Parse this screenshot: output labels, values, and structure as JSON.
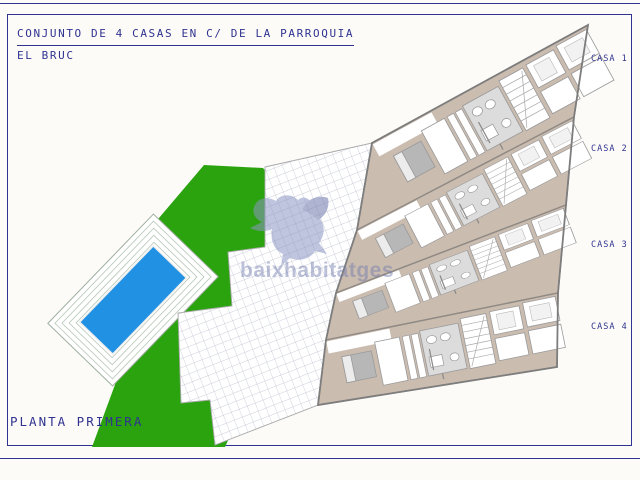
{
  "title_block": {
    "project_title": "CONJUNTO DE 4 CASAS EN C/ DE LA PARROQUIA",
    "location": "EL BRUC"
  },
  "plan": {
    "floor_label": "PLANTA PRIMERA",
    "houses": [
      {
        "label": "CASA 1"
      },
      {
        "label": "CASA 2"
      },
      {
        "label": "CASA 3"
      },
      {
        "label": "CASA 4"
      }
    ],
    "features": {
      "garden": "garden-lawn",
      "pool": "swimming-pool",
      "pool_deck": "pool-deck",
      "terrace": "tiled-terrace",
      "building": "row-of-4-houses"
    }
  },
  "watermark": {
    "text": "baixhabitatges",
    "logo": "dove-icon"
  },
  "colors": {
    "paper": "#fcfbf8",
    "ink": "#303390",
    "garden_green": "#2BA30F",
    "pool_blue": "#2191E3",
    "floor_beige": "#CBBCB0",
    "wall_gray": "#8F8A84",
    "room_line": "#9A9A9A",
    "tile_gray": "#DCDCDC",
    "bed_gray": "#B7B7B7",
    "grid_line": "#BCC0CE",
    "deck_stripe": "#B7C6B7",
    "watermark_blue": "#8C96C4",
    "watermark_dark": "#6F7AAD"
  }
}
